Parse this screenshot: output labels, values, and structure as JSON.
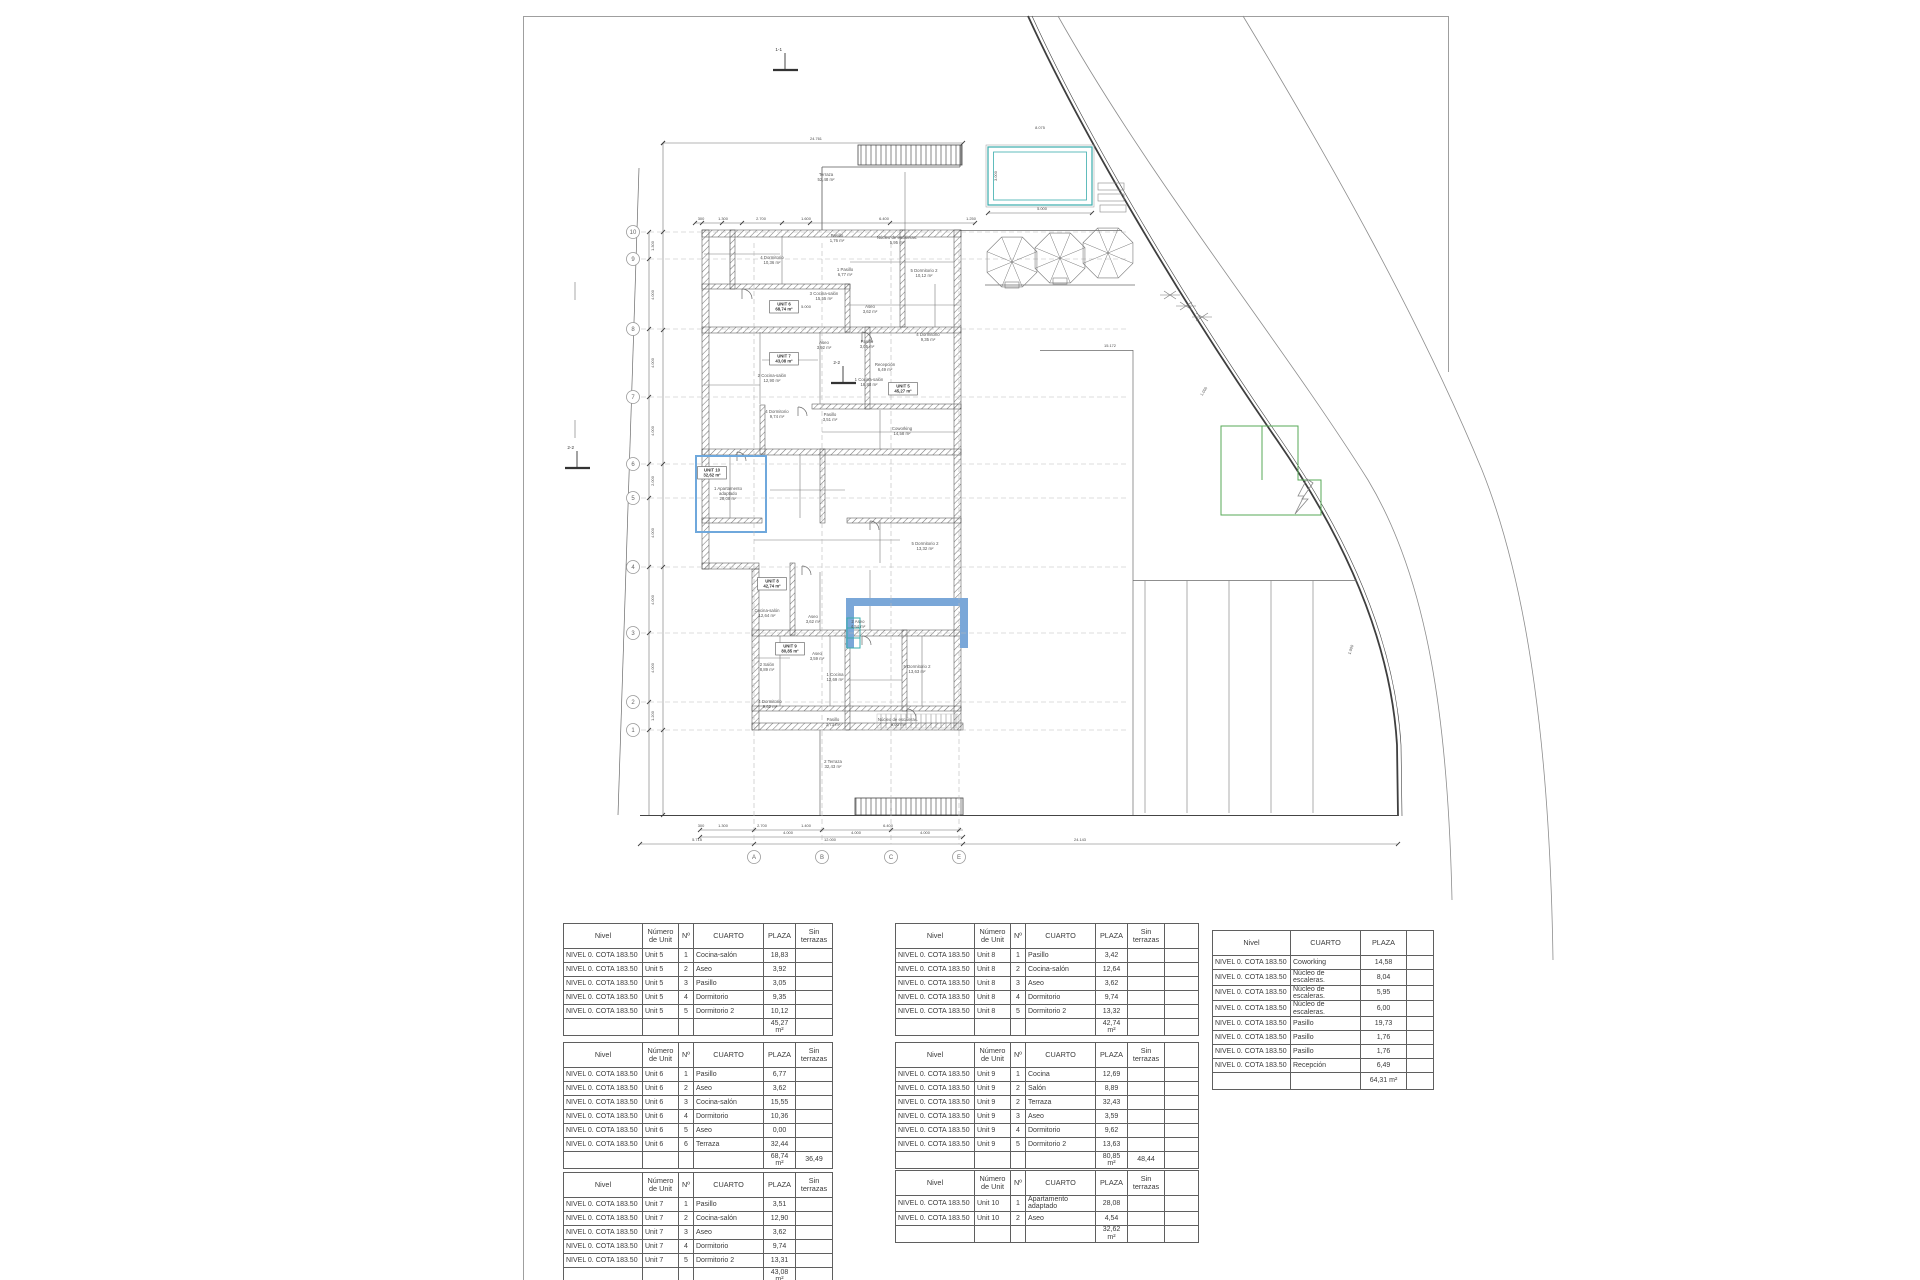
{
  "plan": {
    "colors": {
      "wall": "#4a4a4a",
      "line": "#6a6a6a",
      "accent_blue": "#6fa8dc",
      "teal": "#3aacac",
      "green": "#57a857",
      "grid_bubble": "#9a9a9a"
    },
    "grid_rows": [
      {
        "label": "10",
        "y": 232
      },
      {
        "label": "9",
        "y": 259
      },
      {
        "label": "8",
        "y": 329
      },
      {
        "label": "7",
        "y": 397
      },
      {
        "label": "6",
        "y": 464
      },
      {
        "label": "5",
        "y": 498
      },
      {
        "label": "4",
        "y": 567
      },
      {
        "label": "3",
        "y": 633
      },
      {
        "label": "2",
        "y": 702
      },
      {
        "label": "1",
        "y": 730
      }
    ],
    "grid_cols": [
      {
        "label": "A",
        "x": 754
      },
      {
        "label": "B",
        "x": 822
      },
      {
        "label": "C",
        "x": 891
      },
      {
        "label": "E",
        "x": 959
      }
    ],
    "section_markers": [
      {
        "label": "1-1",
        "x": 785,
        "y": 62
      },
      {
        "label": "2-2",
        "x": 577,
        "y": 460
      },
      {
        "label": "2-2",
        "x": 843,
        "y": 375
      }
    ],
    "room_labels": [
      {
        "x": 826,
        "y": 176,
        "lines": [
          "Terraza",
          "52,48 m²"
        ]
      },
      {
        "x": 837,
        "y": 237,
        "lines": [
          "Pasillo",
          "1,76 m²"
        ]
      },
      {
        "x": 897,
        "y": 239,
        "lines": [
          "Núcleo de escaleras.",
          "5,95 m²"
        ]
      },
      {
        "x": 772,
        "y": 259,
        "lines": [
          "4 Dormitorio",
          "10,36 m²"
        ]
      },
      {
        "x": 845,
        "y": 271,
        "lines": [
          "1 Pasillo",
          "6,77 m²"
        ]
      },
      {
        "x": 924,
        "y": 272,
        "lines": [
          "5 Dormitorio 2",
          "10,12 m²"
        ]
      },
      {
        "x": 824,
        "y": 295,
        "lines": [
          "3 Cocina-salón",
          "15,55 m²"
        ]
      },
      {
        "x": 870,
        "y": 308,
        "lines": [
          "Aseo",
          "3,62 m²"
        ]
      },
      {
        "x": 928,
        "y": 336,
        "lines": [
          "4 Dormitorio",
          "9,35 m²"
        ]
      },
      {
        "x": 824,
        "y": 344,
        "lines": [
          "Aseo",
          "3,92 m²"
        ]
      },
      {
        "x": 867,
        "y": 343,
        "lines": [
          "Pasillo",
          "3,05 m²"
        ]
      },
      {
        "x": 772,
        "y": 377,
        "lines": [
          "2 Cocina-salón",
          "12,90 m²"
        ]
      },
      {
        "x": 869,
        "y": 381,
        "lines": [
          "1 Cocina-salón",
          "18,83 m²"
        ]
      },
      {
        "x": 777,
        "y": 413,
        "lines": [
          "4 Dormitorio",
          "9,74 m²"
        ]
      },
      {
        "x": 830,
        "y": 416,
        "lines": [
          "Pasillo",
          "3,51 m²"
        ]
      },
      {
        "x": 885,
        "y": 366,
        "lines": [
          "Recepción",
          "6,49 m²"
        ]
      },
      {
        "x": 902,
        "y": 430,
        "lines": [
          "Coworking",
          "14,58 m²"
        ]
      },
      {
        "x": 925,
        "y": 545,
        "lines": [
          "5 Dormitorio 2",
          "13,32 m²"
        ]
      },
      {
        "x": 728,
        "y": 490,
        "lines": [
          "1 Apartamento",
          "adaptado",
          "28,08 m²"
        ]
      },
      {
        "x": 767,
        "y": 612,
        "lines": [
          "Cocina-salón",
          "12,64 m²"
        ]
      },
      {
        "x": 813,
        "y": 618,
        "lines": [
          "Aseo",
          "3,62 m²"
        ]
      },
      {
        "x": 858,
        "y": 623,
        "lines": [
          "2 Aseo",
          "4,54 m²"
        ]
      },
      {
        "x": 917,
        "y": 668,
        "lines": [
          "5 Dormitorio 2",
          "13,63 m²"
        ]
      },
      {
        "x": 817,
        "y": 655,
        "lines": [
          "Aseo",
          "3,59 m²"
        ]
      },
      {
        "x": 767,
        "y": 666,
        "lines": [
          "2 Salón",
          "8,89 m²"
        ]
      },
      {
        "x": 835,
        "y": 676,
        "lines": [
          "1 Cocina",
          "12,69 m²"
        ]
      },
      {
        "x": 770,
        "y": 703,
        "lines": [
          "4 Dormitorio",
          "9,62 m²"
        ]
      },
      {
        "x": 833,
        "y": 721,
        "lines": [
          "Pasillo",
          "3,73 m²"
        ]
      },
      {
        "x": 898,
        "y": 721,
        "lines": [
          "Núcleo de escaleras.",
          "6,00 m²"
        ]
      },
      {
        "x": 833,
        "y": 763,
        "lines": [
          "2 Terraza",
          "32,43 m²"
        ]
      }
    ],
    "unit_boxes": [
      {
        "x": 784,
        "y": 306,
        "lines": [
          "UNIT 6",
          "68,74 m²"
        ]
      },
      {
        "x": 784,
        "y": 358,
        "lines": [
          "UNIT 7",
          "43,08 m²"
        ]
      },
      {
        "x": 903,
        "y": 388,
        "lines": [
          "UNIT 5",
          "45,27 m²"
        ]
      },
      {
        "x": 712,
        "y": 472,
        "lines": [
          "UNIT 10",
          "32,62 m²"
        ]
      },
      {
        "x": 772,
        "y": 583,
        "lines": [
          "UNIT 8",
          "42,74 m²"
        ]
      },
      {
        "x": 790,
        "y": 648,
        "lines": [
          "UNIT 9",
          "80,85 m²"
        ]
      }
    ],
    "dim_labels": [
      {
        "x": 816,
        "y": 140,
        "t": "24.761"
      },
      {
        "x": 1040,
        "y": 129,
        "t": "8.075"
      },
      {
        "x": 1042,
        "y": 210,
        "t": "5.000"
      },
      {
        "x": 997,
        "y": 176,
        "t": "3.000",
        "r": -90
      },
      {
        "x": 806,
        "y": 308,
        "t": "5.000"
      },
      {
        "x": 1110,
        "y": 347,
        "t": "15.172"
      },
      {
        "x": 701,
        "y": 220,
        "t": "300"
      },
      {
        "x": 723,
        "y": 220,
        "t": "1.300"
      },
      {
        "x": 761,
        "y": 220,
        "t": "2.700"
      },
      {
        "x": 806,
        "y": 220,
        "t": "1.600"
      },
      {
        "x": 884,
        "y": 220,
        "t": "6.400"
      },
      {
        "x": 971,
        "y": 220,
        "t": "1.250"
      },
      {
        "x": 701,
        "y": 827,
        "t": "300"
      },
      {
        "x": 723,
        "y": 827,
        "t": "1.300"
      },
      {
        "x": 762,
        "y": 827,
        "t": "2.700"
      },
      {
        "x": 806,
        "y": 827,
        "t": "1.400"
      },
      {
        "x": 888,
        "y": 827,
        "t": "6.400"
      },
      {
        "x": 788,
        "y": 834,
        "t": "4.000"
      },
      {
        "x": 856,
        "y": 834,
        "t": "4.000"
      },
      {
        "x": 925,
        "y": 834,
        "t": "4.000"
      },
      {
        "x": 830,
        "y": 841,
        "t": "12.000"
      },
      {
        "x": 697,
        "y": 841,
        "t": "5.715"
      },
      {
        "x": 1080,
        "y": 841,
        "t": "24.143"
      },
      {
        "x": 654,
        "y": 246,
        "t": "1.300",
        "r": -90
      },
      {
        "x": 654,
        "y": 295,
        "t": "4.000",
        "r": -90
      },
      {
        "x": 654,
        "y": 363,
        "t": "4.000",
        "r": -90
      },
      {
        "x": 654,
        "y": 431,
        "t": "4.000",
        "r": -90
      },
      {
        "x": 654,
        "y": 481,
        "t": "2.000",
        "r": -90
      },
      {
        "x": 654,
        "y": 533,
        "t": "4.000",
        "r": -90
      },
      {
        "x": 654,
        "y": 600,
        "t": "4.000",
        "r": -90
      },
      {
        "x": 654,
        "y": 668,
        "t": "4.000",
        "r": -90
      },
      {
        "x": 654,
        "y": 716,
        "t": "1.200",
        "r": -90
      },
      {
        "x": 1205,
        "y": 392,
        "t": "1.000",
        "r": -58
      },
      {
        "x": 1352,
        "y": 650,
        "t": "1.000",
        "r": -72
      }
    ]
  },
  "tables": {
    "headers_unit": [
      "Nivel",
      "Número\nde Unit",
      "Nº",
      "CUARTO",
      "PLAZA",
      "Sin\nterrazas"
    ],
    "headers_common": [
      "Nivel",
      "CUARTO",
      "PLAZA"
    ],
    "unit_col_widths": [
      79,
      36,
      15,
      70,
      32,
      37
    ],
    "common_col_widths": [
      78,
      70,
      46
    ],
    "tail_width": 34,
    "common_tail_width": 27,
    "unit_tables": [
      {
        "id": "t-unit5",
        "tail": false,
        "nivel": "NIVEL 0. COTA 183.50",
        "unit": "Unit 5",
        "rows": [
          [
            "1",
            "Cocina-salón",
            "18,83"
          ],
          [
            "2",
            "Aseo",
            "3,92"
          ],
          [
            "3",
            "Pasillo",
            "3,05"
          ],
          [
            "4",
            "Dormitorio",
            "9,35"
          ],
          [
            "5",
            "Dormitorio 2",
            "10,12"
          ]
        ],
        "total": "45,27 m²",
        "total_sin": ""
      },
      {
        "id": "t-unit6",
        "tail": false,
        "nivel": "NIVEL 0. COTA 183.50",
        "unit": "Unit 6",
        "rows": [
          [
            "1",
            "Pasillo",
            "6,77"
          ],
          [
            "2",
            "Aseo",
            "3,62"
          ],
          [
            "3",
            "Cocina-salón",
            "15,55"
          ],
          [
            "4",
            "Dormitorio",
            "10,36"
          ],
          [
            "5",
            "Aseo",
            "0,00"
          ],
          [
            "6",
            "Terraza",
            "32,44"
          ]
        ],
        "total": "68,74 m²",
        "total_sin": "36,49"
      },
      {
        "id": "t-unit7",
        "tail": false,
        "nivel": "NIVEL 0. COTA 183.50",
        "unit": "Unit 7",
        "rows": [
          [
            "1",
            "Pasillo",
            "3,51"
          ],
          [
            "2",
            "Cocina-salón",
            "12,90"
          ],
          [
            "3",
            "Aseo",
            "3,62"
          ],
          [
            "4",
            "Dormitorio",
            "9,74"
          ],
          [
            "5",
            "Dormitorio 2",
            "13,31"
          ]
        ],
        "total": "43,08 m²",
        "total_sin": ""
      },
      {
        "id": "t-unit8",
        "tail": true,
        "nivel": "NIVEL 0. COTA 183.50",
        "unit": "Unit 8",
        "rows": [
          [
            "1",
            "Pasillo",
            "3,42"
          ],
          [
            "2",
            "Cocina-salón",
            "12,64"
          ],
          [
            "3",
            "Aseo",
            "3,62"
          ],
          [
            "4",
            "Dormitorio",
            "9,74"
          ],
          [
            "5",
            "Dormitorio 2",
            "13,32"
          ]
        ],
        "total": "42,74 m²",
        "total_sin": ""
      },
      {
        "id": "t-unit9",
        "tail": true,
        "nivel": "NIVEL 0. COTA 183.50",
        "unit": "Unit 9",
        "rows": [
          [
            "1",
            "Cocina",
            "12,69"
          ],
          [
            "2",
            "Salón",
            "8,89"
          ],
          [
            "2",
            "Terraza",
            "32,43"
          ],
          [
            "3",
            "Aseo",
            "3,59"
          ],
          [
            "4",
            "Dormitorio",
            "9,62"
          ],
          [
            "5",
            "Dormitorio 2",
            "13,63"
          ]
        ],
        "total": "80,85 m²",
        "total_sin": "48,44"
      },
      {
        "id": "t-unit10",
        "tail": true,
        "nivel": "NIVEL 0. COTA 183.50",
        "unit": "Unit 10",
        "rows": [
          [
            "1",
            "Apartamento adaptado",
            "28,08"
          ],
          [
            "2",
            "Aseo",
            "4,54"
          ]
        ],
        "total": "32,62 m²",
        "total_sin": ""
      }
    ],
    "common_table": {
      "id": "t-common",
      "nivel": "NIVEL 0. COTA 183.50",
      "rows": [
        [
          "Coworking",
          "14,58"
        ],
        [
          "Núcleo de escaleras.",
          "8,04"
        ],
        [
          "Núcleo de escaleras.",
          "5,95"
        ],
        [
          "Núcleo de escaleras.",
          "6,00"
        ],
        [
          "Pasillo",
          "19,73"
        ],
        [
          "Pasillo",
          "1,76"
        ],
        [
          "Pasillo",
          "1,76"
        ],
        [
          "Recepción",
          "6,49"
        ]
      ],
      "total": "64,31 m²"
    }
  }
}
